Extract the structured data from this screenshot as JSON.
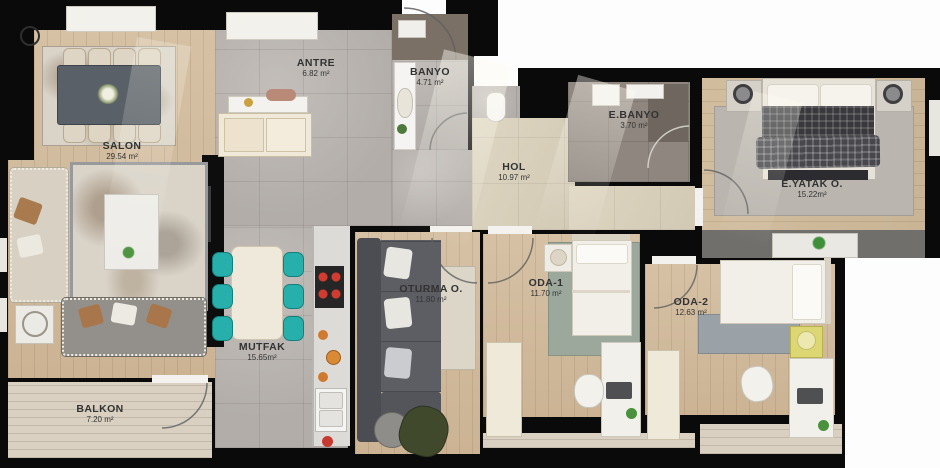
{
  "rooms": {
    "salon": {
      "name": "SALON",
      "area": "29.54 m²"
    },
    "antre": {
      "name": "ANTRE",
      "area": "6.82 m²"
    },
    "banyo": {
      "name": "BANYO",
      "area": "4.71 m²"
    },
    "ebanyo": {
      "name": "E.BANYO",
      "area": "3.70 m²"
    },
    "hol": {
      "name": "HOL",
      "area": "10.97 m²"
    },
    "eyatak": {
      "name": "E.YATAK O.",
      "area": "15.22m²"
    },
    "oturma": {
      "name": "OTURMA O.",
      "area": "11.80 m²"
    },
    "oda1": {
      "name": "ODA-1",
      "area": "11.70 m²"
    },
    "oda2": {
      "name": "ODA-2",
      "area": "12.63 m²"
    },
    "mutfak": {
      "name": "MUTFAK",
      "area": "15.65m²"
    },
    "balkon": {
      "name": "BALKON",
      "area": "7.20 m²"
    }
  },
  "colors": {
    "wall": "#0a0a0a",
    "wood": "#d2bd9f",
    "tile_gray": "#b7b2ae",
    "tile_cream": "#d9d0bd",
    "accent_teal": "#27b0ab",
    "stove_burner": "#d23c30",
    "label_text": "#333333"
  }
}
